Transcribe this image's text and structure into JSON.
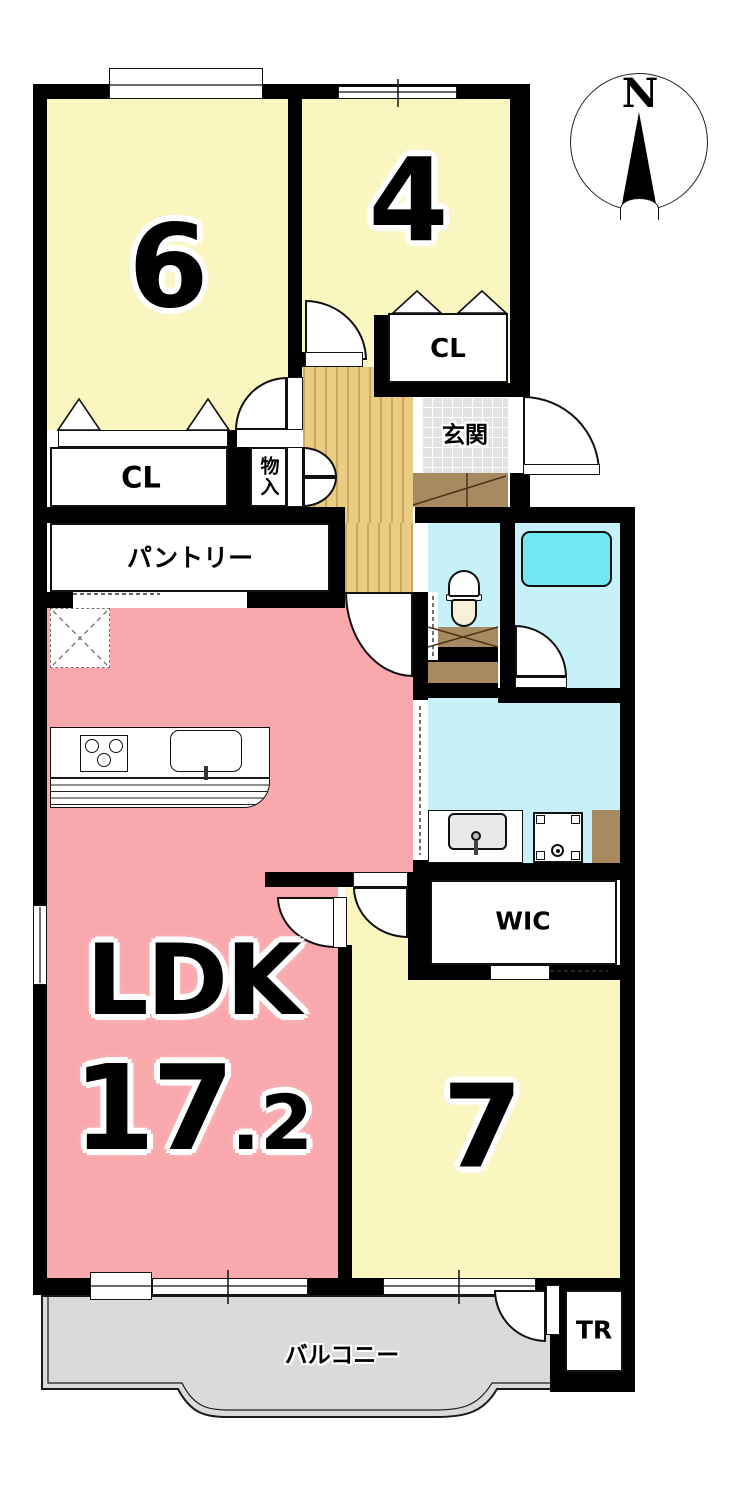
{
  "compass": {
    "north_label": "N"
  },
  "rooms": {
    "bedroom_6": {
      "label": "6"
    },
    "bedroom_4": {
      "label": "4"
    },
    "closet_upper": {
      "label": "CL"
    },
    "entrance": {
      "label": "玄関"
    },
    "closet_lower": {
      "label": "CL"
    },
    "storage": {
      "label": "物入"
    },
    "pantry": {
      "label": "パントリー"
    },
    "ldk": {
      "label": "LDK",
      "area_whole": "17",
      "area_fraction": ".2"
    },
    "wic": {
      "label": "WIC"
    },
    "bedroom_7": {
      "label": "7"
    },
    "balcony": {
      "label": "バルコニー"
    },
    "trunk_room": {
      "label": "TR"
    }
  },
  "colors": {
    "wall": "#000000",
    "room_yellow": "#faf6c0",
    "ldk_pink": "#f9a9ad",
    "wet_area_cyan": "#c6f1f8",
    "bathtub_cyan": "#6fe8f2",
    "hall_wood": "#eacd84",
    "entrance_tile": "#e2e2e2",
    "cabinet_brown": "#a78a5f",
    "balcony_gray": "#dadada"
  }
}
